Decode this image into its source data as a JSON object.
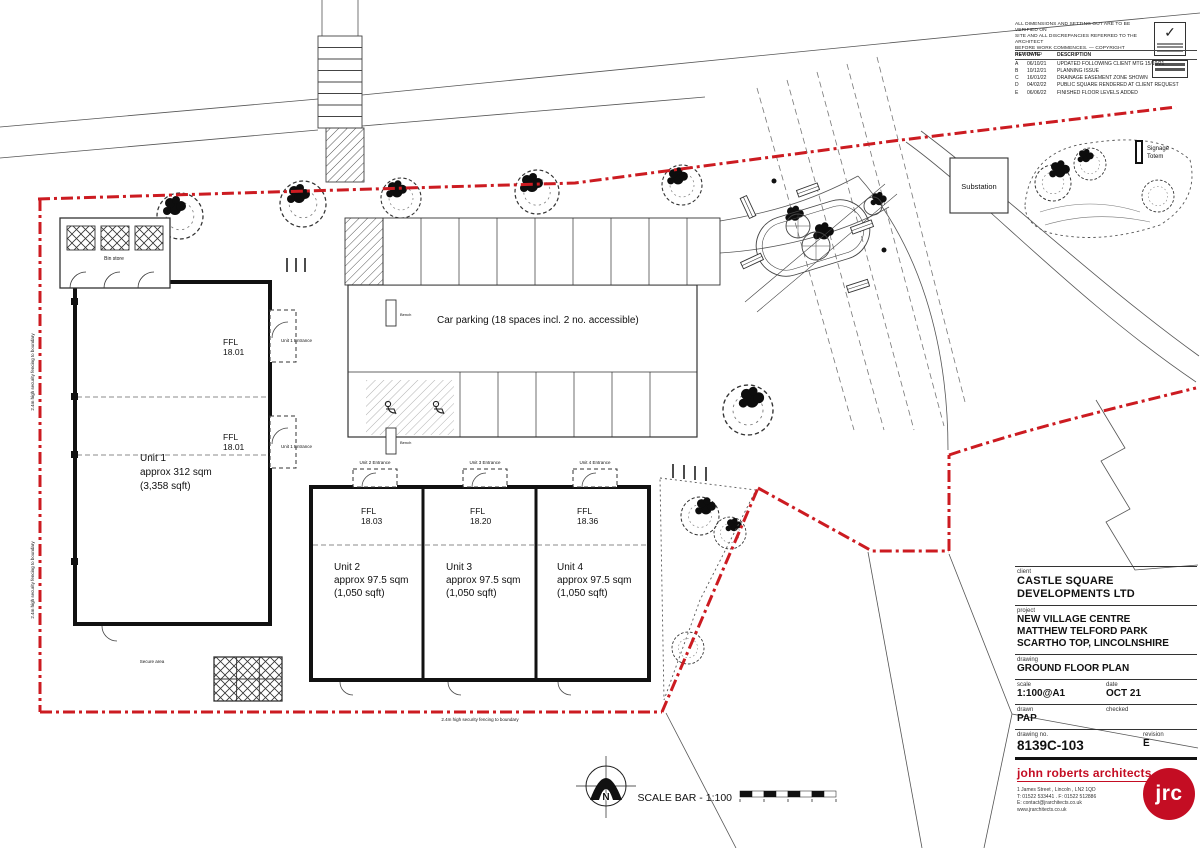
{
  "colors": {
    "accent_red": "#cc1b21",
    "logo_red": "#c40d23",
    "line": "#1c1c1c"
  },
  "icons": {
    "check": "✓",
    "north_letter_note": "compass-north"
  },
  "notes": {
    "line1": "ALL DIMENSIONS AND SETTING OUT ARE TO BE VERIFIED ON",
    "line2": "SITE AND ALL DISCREPANCIES REFERRED TO THE ARCHITECT",
    "line3": "BEFORE WORK COMMENCES.      —      COPYRIGHT RESERVED"
  },
  "revisions": {
    "headers": {
      "rev": "REV.",
      "date": "DATE",
      "desc": "DESCRIPTION"
    },
    "rows": [
      {
        "rev": "A",
        "date": "06/10/21",
        "desc": "UPDATED FOLLOWING CLIENT MTG 15/10/21"
      },
      {
        "rev": "B",
        "date": "10/12/21",
        "desc": "PLANNING ISSUE"
      },
      {
        "rev": "C",
        "date": "16/01/22",
        "desc": "DRAINAGE EASEMENT ZONE SHOWN"
      },
      {
        "rev": "D",
        "date": "04/02/22",
        "desc": "PUBLIC SQUARE RENDERED AT CLIENT REQUEST"
      },
      {
        "rev": "E",
        "date": "06/06/22",
        "desc": "FINISHED FLOOR LEVELS ADDED"
      }
    ]
  },
  "plan": {
    "car_parking": "Car parking (18 spaces incl. 2 no. accessible)",
    "unit1": {
      "name": "Unit 1",
      "area": "approx 312 sqm",
      "area_ft": "(3,358 sqft)",
      "ffl_label": "FFL",
      "ffl": "18.01"
    },
    "unit2": {
      "name": "Unit 2",
      "area": "approx 97.5 sqm",
      "area_ft": "(1,050 sqft)",
      "ffl_label": "FFL",
      "ffl": "18.03"
    },
    "unit3": {
      "name": "Unit 3",
      "area": "approx 97.5 sqm",
      "area_ft": "(1,050 sqft)",
      "ffl_label": "FFL",
      "ffl": "18.20"
    },
    "unit4": {
      "name": "Unit 4",
      "area": "approx 97.5 sqm",
      "area_ft": "(1,050 sqft)",
      "ffl_label": "FFL",
      "ffl": "18.36"
    },
    "entrance1": "Unit 1 Entrance",
    "entrance2": "Unit 2 Entrance",
    "entrance3": "Unit 3 Entrance",
    "entrance4": "Unit 4 Entrance",
    "substation": "Substation",
    "signage_totem_1": "Signage",
    "signage_totem_2": "Totem",
    "bin_store": "Bin store",
    "secure_area": "Secure area",
    "bench": "Bench",
    "fence_note": "2.4m high security fencing to boundary",
    "north": "N",
    "scale_bar": "SCALE BAR - 1:100"
  },
  "title_block": {
    "client_label": "client",
    "client1": "CASTLE SQUARE",
    "client2": "DEVELOPMENTS LTD",
    "project_label": "project",
    "project1": "NEW VILLAGE CENTRE",
    "project2": "MATTHEW TELFORD PARK",
    "project3": "SCARTHO TOP, LINCOLNSHIRE",
    "drawing_label": "drawing",
    "drawing": "GROUND FLOOR PLAN",
    "scale_label": "scale",
    "scale": "1:100@A1",
    "date_label": "date",
    "date": "OCT 21",
    "drawn_label": "drawn",
    "drawn": "PAP",
    "checked_label": "checked",
    "checked": "",
    "drawing_no_label": "drawing  no.",
    "drawing_no": "8139C-103",
    "revision_label": "revision",
    "revision": "E"
  },
  "firm": {
    "name": "john roberts architects",
    "address": "1 James Street , Lincoln , LN2 1QD",
    "phones": "T: 01522 533441  .  F: 01522 512886",
    "email": "E: contact@jrarchitects.co.uk",
    "web": "www.jrarchitects.co.uk",
    "logo": "jrc"
  }
}
